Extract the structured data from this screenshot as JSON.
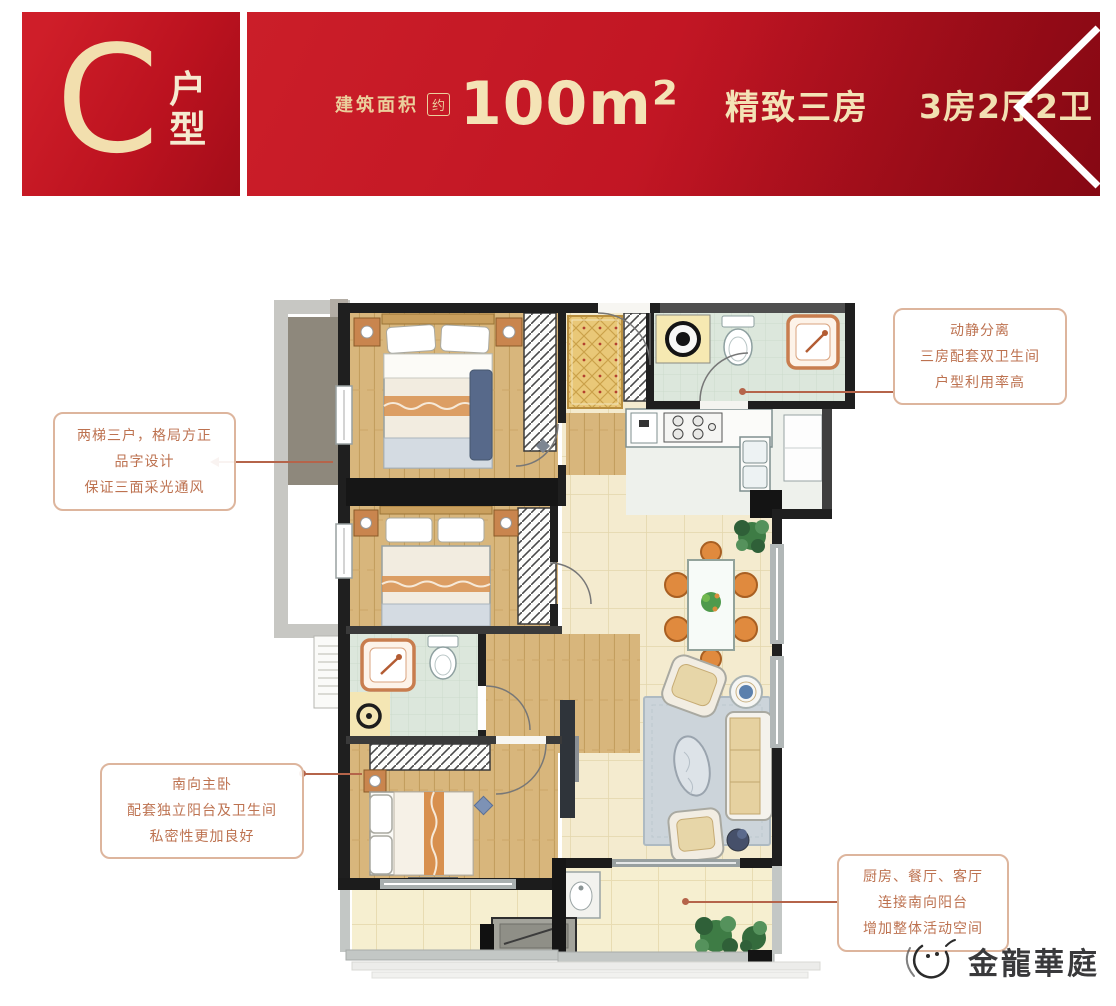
{
  "header": {
    "unit_letter": "C",
    "unit_label_top": "户",
    "unit_label_bottom": "型",
    "area_label": "建筑面积",
    "area_approx": "约",
    "area_value": "100m²",
    "tagline": "精致三房",
    "layout_spec": "3房2厅2卫"
  },
  "callouts": {
    "top_right": {
      "lines": [
        "动静分离",
        "三房配套双卫生间",
        "户型利用率高"
      ]
    },
    "left": {
      "lines": [
        "两梯三户，格局方正",
        "品字设计",
        "保证三面采光通风"
      ]
    },
    "bottom_left": {
      "lines": [
        "南向主卧",
        "配套独立阳台及卫生间",
        "私密性更加良好"
      ]
    },
    "bottom_right": {
      "lines": [
        "厨房、餐厅、客厅",
        "连接南向阳台",
        "增加整体活动空间"
      ]
    }
  },
  "logo": {
    "name": "金龍華庭"
  },
  "colors": {
    "banner_red": "#c01523",
    "banner_cream": "#f4e3b6",
    "callout_text": "#bd7250",
    "callout_border": "#ddb59d",
    "leader_line": "#b5644a"
  }
}
